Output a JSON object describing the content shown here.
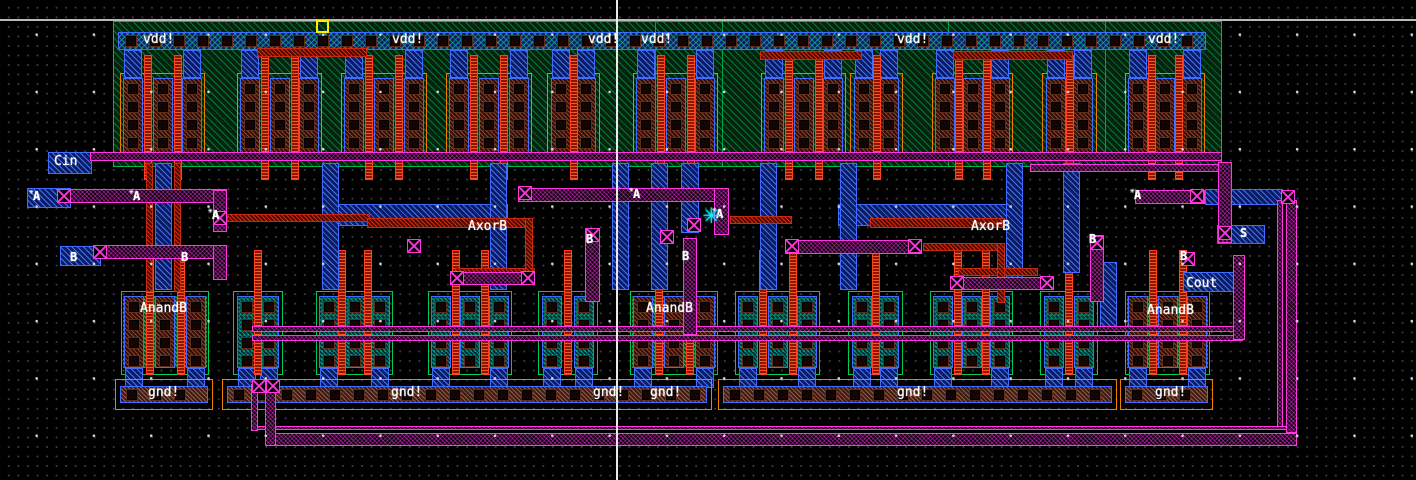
{
  "app": {
    "description": "IC layout editor canvas showing a CMOS full-adder standard cell",
    "canvas": {
      "width": 1416,
      "height": 480,
      "background": "#000000"
    },
    "grid": {
      "minor_pitch": 9.55,
      "major_pitch": 57.3,
      "minor_color": "#3d3f49",
      "major_color": "#d6d6de"
    },
    "crosshair": {
      "vline_x": 616,
      "hline_y": 19
    },
    "origin_marker": {
      "x": 316,
      "y": 20,
      "color": "#ffee00"
    },
    "cursor": {
      "x": 703,
      "y": 200,
      "color": "#12e9ff",
      "glyph": "✳"
    }
  },
  "colors": {
    "nwell_green": "#00b44e",
    "metal1_blue": "#3f6bff",
    "metal2_magenta": "#ff35e0",
    "poly_red": "#ff3714",
    "pdiff_brown": "#eb734b",
    "ndiff_teal": "#00e1a5",
    "ndiff_green": "#3cff8c",
    "guard_orange": "#ef7d00",
    "label_white": "#ffffff",
    "cursor_cyan": "#12e9ff",
    "marker_yellow": "#ffee00"
  },
  "labels": {
    "power": [
      {
        "text": "vdd!",
        "x": 143,
        "y": 33
      },
      {
        "text": "vdd!",
        "x": 392,
        "y": 33
      },
      {
        "text": "vdd!",
        "x": 588,
        "y": 33
      },
      {
        "text": "vdd!",
        "x": 641,
        "y": 33
      },
      {
        "text": "vdd!",
        "x": 897,
        "y": 33
      },
      {
        "text": "vdd!",
        "x": 1148,
        "y": 33
      }
    ],
    "ground": [
      {
        "text": "gnd!",
        "x": 148,
        "y": 386
      },
      {
        "text": "gnd!",
        "x": 391,
        "y": 386
      },
      {
        "text": "gnd!",
        "x": 593,
        "y": 386
      },
      {
        "text": "gnd!",
        "x": 650,
        "y": 386
      },
      {
        "text": "gnd!",
        "x": 897,
        "y": 386
      },
      {
        "text": "gnd!",
        "x": 1155,
        "y": 386
      }
    ],
    "ports": [
      {
        "text": "Cin",
        "x": 54,
        "y": 155
      },
      {
        "text": "Cout",
        "x": 1186,
        "y": 277
      }
    ],
    "nets": [
      {
        "text": "AxorB",
        "x": 468,
        "y": 220
      },
      {
        "text": "AxorB",
        "x": 971,
        "y": 220
      },
      {
        "text": "AnandB",
        "x": 140,
        "y": 302
      },
      {
        "text": "AnandB",
        "x": 646,
        "y": 302
      },
      {
        "text": "AnandB",
        "x": 1147,
        "y": 304
      }
    ],
    "pins": [
      {
        "text": "A",
        "x": 33,
        "y": 190,
        "star": true
      },
      {
        "text": "A",
        "x": 133,
        "y": 190,
        "star": true
      },
      {
        "text": "A",
        "x": 212,
        "y": 209,
        "star": true
      },
      {
        "text": "A",
        "x": 633,
        "y": 188,
        "star": true
      },
      {
        "text": "A",
        "x": 716,
        "y": 208,
        "star": true
      },
      {
        "text": "A",
        "x": 1134,
        "y": 189,
        "star": true
      },
      {
        "text": "B",
        "x": 70,
        "y": 251,
        "star": false
      },
      {
        "text": "B",
        "x": 181,
        "y": 251,
        "star": false
      },
      {
        "text": "B",
        "x": 586,
        "y": 233,
        "star": false
      },
      {
        "text": "B",
        "x": 682,
        "y": 250,
        "star": false
      },
      {
        "text": "B",
        "x": 1089,
        "y": 233,
        "star": false
      },
      {
        "text": "B",
        "x": 1180,
        "y": 250,
        "star": false
      },
      {
        "text": "S",
        "x": 1240,
        "y": 227,
        "star": false
      }
    ]
  },
  "geometry": {
    "rect_format": "[x, y, w, h] in canvas pixels",
    "nwell": [
      113,
      21,
      1109,
      146
    ],
    "nwell_dividers_x": [
      655,
      722,
      948,
      1105
    ],
    "vdd_rail": {
      "rect": [
        118,
        32,
        1088,
        18
      ],
      "contact_start_x": 126,
      "contact_step": 24,
      "contact_y": 36,
      "contact_size": 10
    },
    "gnd_rails": {
      "y": 379,
      "h": 31,
      "segments": [
        [
          115,
          98
        ],
        [
          222,
          490
        ],
        [
          718,
          399
        ],
        [
          1120,
          93
        ]
      ]
    },
    "pmos_groups": [
      [
        120,
        85,
        3
      ],
      [
        237,
        85,
        3
      ],
      [
        341,
        86,
        3
      ],
      [
        446,
        86,
        3
      ],
      [
        547,
        53,
        2
      ],
      [
        633,
        85,
        3
      ],
      [
        761,
        85,
        3
      ],
      [
        850,
        53,
        2
      ],
      [
        932,
        81,
        3
      ],
      [
        1042,
        55,
        2
      ],
      [
        1125,
        80,
        3
      ]
    ],
    "nmos_groups": [
      [
        121,
        88,
        3,
        1
      ],
      [
        233,
        50,
        2,
        0
      ],
      [
        316,
        77,
        3,
        0
      ],
      [
        428,
        84,
        3,
        0
      ],
      [
        538,
        60,
        2,
        0
      ],
      [
        630,
        88,
        3,
        1
      ],
      [
        735,
        85,
        3,
        0
      ],
      [
        848,
        55,
        2,
        0
      ],
      [
        930,
        83,
        3,
        0
      ],
      [
        1040,
        58,
        2,
        0
      ],
      [
        1125,
        85,
        3,
        1
      ]
    ],
    "m1_shapes": [
      [
        48,
        152,
        44,
        22
      ],
      [
        27,
        188,
        44,
        20
      ],
      [
        60,
        246,
        41,
        20
      ],
      [
        323,
        204,
        185,
        22
      ],
      [
        838,
        204,
        174,
        22
      ],
      [
        1205,
        189,
        78,
        16
      ],
      [
        1217,
        225,
        48,
        19
      ],
      [
        1183,
        272,
        57,
        20
      ],
      [
        155,
        163,
        17,
        127
      ],
      [
        322,
        163,
        17,
        127
      ],
      [
        490,
        163,
        17,
        127
      ],
      [
        612,
        163,
        17,
        127
      ],
      [
        651,
        163,
        17,
        127
      ],
      [
        681,
        163,
        18,
        70
      ],
      [
        760,
        163,
        17,
        127
      ],
      [
        840,
        163,
        17,
        127
      ],
      [
        1006,
        163,
        17,
        127
      ],
      [
        1063,
        163,
        17,
        110
      ],
      [
        1100,
        262,
        17,
        68
      ]
    ],
    "m2_wires": [
      [
        90,
        152,
        1132,
        9
      ],
      [
        1030,
        164,
        192,
        8
      ],
      [
        57,
        189,
        170,
        14
      ],
      [
        93,
        245,
        134,
        14
      ],
      [
        518,
        188,
        211,
        14
      ],
      [
        785,
        240,
        137,
        14
      ],
      [
        1135,
        190,
        70,
        14
      ],
      [
        450,
        272,
        85,
        13
      ],
      [
        950,
        277,
        92,
        13
      ],
      [
        252,
        326,
        991,
        6
      ],
      [
        252,
        335,
        991,
        6
      ],
      [
        255,
        426,
        1035,
        4
      ],
      [
        267,
        433,
        1030,
        13
      ],
      [
        213,
        190,
        14,
        42
      ],
      [
        213,
        245,
        14,
        35
      ],
      [
        585,
        228,
        15,
        74
      ],
      [
        683,
        238,
        14,
        97
      ],
      [
        714,
        188,
        15,
        47
      ],
      [
        1090,
        235,
        14,
        67
      ],
      [
        1218,
        162,
        14,
        81
      ],
      [
        1233,
        255,
        12,
        85
      ],
      [
        1277,
        200,
        6,
        227
      ],
      [
        1286,
        200,
        11,
        233
      ],
      [
        251,
        384,
        7,
        47
      ],
      [
        265,
        384,
        11,
        62
      ]
    ],
    "poly_wires": [
      [
        227,
        214,
        143,
        8
      ],
      [
        367,
        218,
        166,
        10
      ],
      [
        455,
        268,
        80,
        8
      ],
      [
        730,
        216,
        62,
        8
      ],
      [
        870,
        218,
        135,
        10
      ],
      [
        923,
        243,
        82,
        8
      ],
      [
        958,
        268,
        80,
        8
      ],
      [
        257,
        48,
        110,
        9
      ],
      [
        760,
        51,
        102,
        9
      ],
      [
        953,
        51,
        120,
        9
      ],
      [
        146,
        163,
        7,
        129
      ],
      [
        174,
        163,
        7,
        129
      ],
      [
        525,
        218,
        8,
        60
      ],
      [
        997,
        243,
        8,
        60
      ]
    ],
    "vias": [
      [
        57,
        189
      ],
      [
        93,
        245
      ],
      [
        213,
        211
      ],
      [
        407,
        239
      ],
      [
        518,
        186
      ],
      [
        586,
        228
      ],
      [
        660,
        230
      ],
      [
        687,
        218
      ],
      [
        785,
        239
      ],
      [
        908,
        239
      ],
      [
        450,
        271
      ],
      [
        521,
        271
      ],
      [
        950,
        276
      ],
      [
        1040,
        276
      ],
      [
        1090,
        236
      ],
      [
        1181,
        252
      ],
      [
        1190,
        189
      ],
      [
        1218,
        226
      ],
      [
        1281,
        190
      ],
      [
        252,
        379
      ],
      [
        266,
        379
      ]
    ]
  }
}
